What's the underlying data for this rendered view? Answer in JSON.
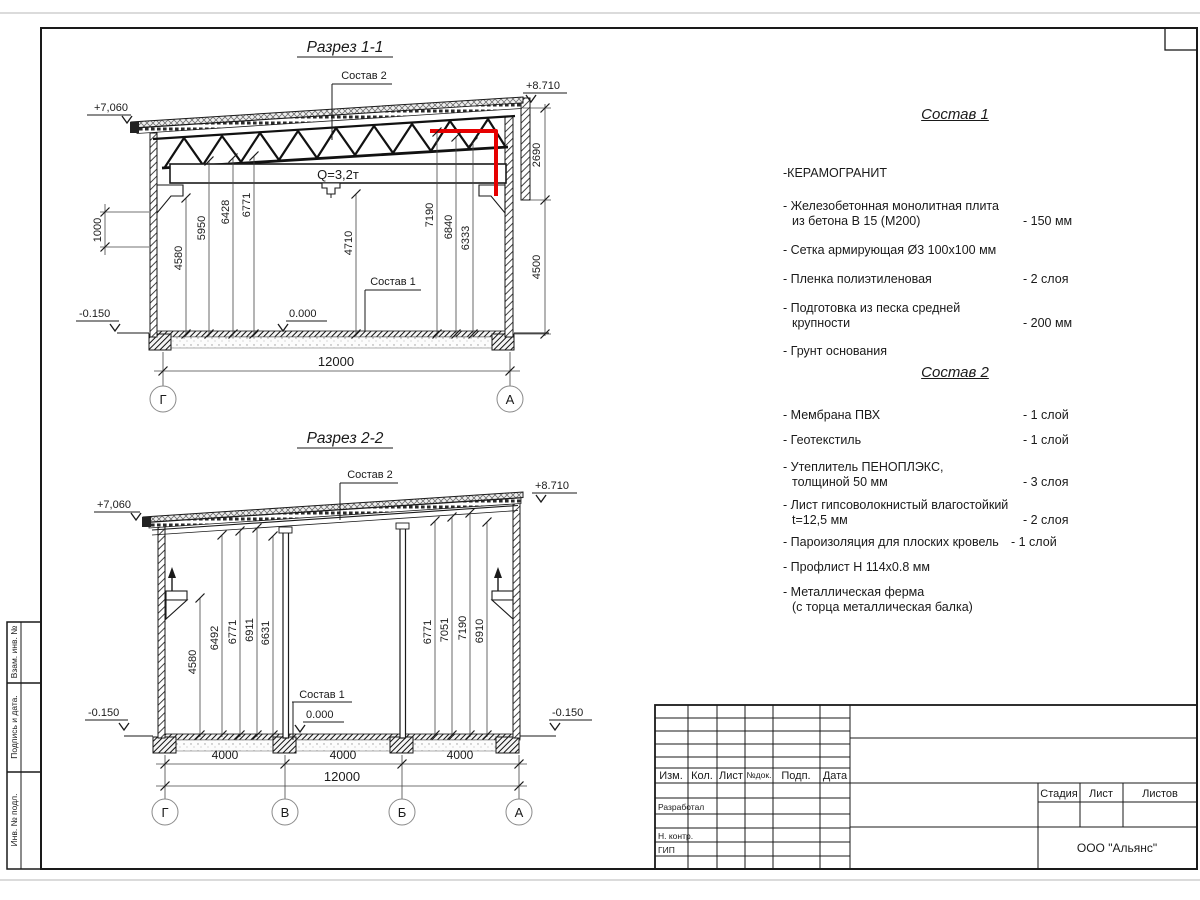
{
  "page": {
    "accent_red": "#e60000"
  },
  "section1": {
    "title": "Разрез 1-1",
    "label_sostav2": "Состав 2",
    "label_sostav1": "Состав 1",
    "level_top_left": "+7,060",
    "level_top_right": "+8.710",
    "level_zero": "0.000",
    "level_ground": "-0.150",
    "crane_capacity": "Q=3,2т",
    "dim_wall": "1000",
    "dims_interior": [
      "4580",
      "5950",
      "6428",
      "6771",
      "4710",
      "7190",
      "6840",
      "6333"
    ],
    "dim_parapet": "2690",
    "dim_right": "4500",
    "dim_total": "12000",
    "axis_left": "Г",
    "axis_right": "А"
  },
  "section2": {
    "title": "Разрез 2-2",
    "label_sostav2": "Состав 2",
    "label_sostav1": "Состав 1",
    "level_top_left": "+7,060",
    "level_top_right": "+8.710",
    "level_zero": "0.000",
    "level_ground_left": "-0.150",
    "level_ground_right": "-0.150",
    "dims_left": [
      "4580",
      "6492",
      "6771",
      "6911",
      "6631"
    ],
    "dims_right": [
      "6771",
      "7051",
      "7190",
      "6910"
    ],
    "dims_bays": [
      "4000",
      "4000",
      "4000"
    ],
    "dim_total": "12000",
    "axes": [
      "Г",
      "В",
      "Б",
      "А"
    ]
  },
  "sostav1": {
    "title": "Состав 1",
    "items": [
      {
        "line1": "-КЕРАМОГРАНИТ",
        "line2": "",
        "value": ""
      },
      {
        "line1": "- Железобетонная  монолитная плита",
        "line2": "из бетона В 15 (М200)",
        "value": "- 150 мм"
      },
      {
        "line1": "- Сетка армирующая Ø3 100х100 мм",
        "line2": "",
        "value": ""
      },
      {
        "line1": "- Пленка полиэтиленовая",
        "line2": "",
        "value": "- 2 слоя"
      },
      {
        "line1": "- Подготовка из песка средней",
        "line2": "крупности",
        "value": "- 200 мм"
      },
      {
        "line1": "- Грунт основания",
        "line2": "",
        "value": ""
      }
    ]
  },
  "sostav2": {
    "title": "Состав 2",
    "items": [
      {
        "line1": "- Мембрана ПВХ",
        "line2": "",
        "value": "- 1 слой"
      },
      {
        "line1": "- Геотекстиль",
        "line2": "",
        "value": "- 1 слой"
      },
      {
        "line1": "- Утеплитель ПЕНОПЛЭКС,",
        "line2": "толщиной 50 мм",
        "value": "- 3 слоя"
      },
      {
        "line1": "- Лист гипсоволокнистый влагостойкий",
        "line2": "t=12,5 мм",
        "value": "- 2 слоя"
      },
      {
        "line1": "- Пароизоляция для плоских кровель",
        "line2": "",
        "value": "- 1 слой"
      },
      {
        "line1": "- Профлист Н 114х0.8 мм",
        "line2": "",
        "value": ""
      },
      {
        "line1": "- Металлическая ферма",
        "line2": "(с торца металлическая балка)",
        "value": ""
      }
    ]
  },
  "titleblock": {
    "rev_headers": [
      "Изм.",
      "Кол.",
      "Лист",
      "№док.",
      "Подп.",
      "Дата"
    ],
    "row_developed": "Разработал",
    "row_ncontrol": "Н. контр.",
    "row_gip": "ГИП",
    "stage_label": "Стадия",
    "sheet_label": "Лист",
    "sheets_label": "Листов",
    "company": "ООО \"Альянс\""
  },
  "sidebar": {
    "rows": [
      "Взам. инв. №",
      "Подпись и дата.",
      "Инв. № подл."
    ]
  }
}
